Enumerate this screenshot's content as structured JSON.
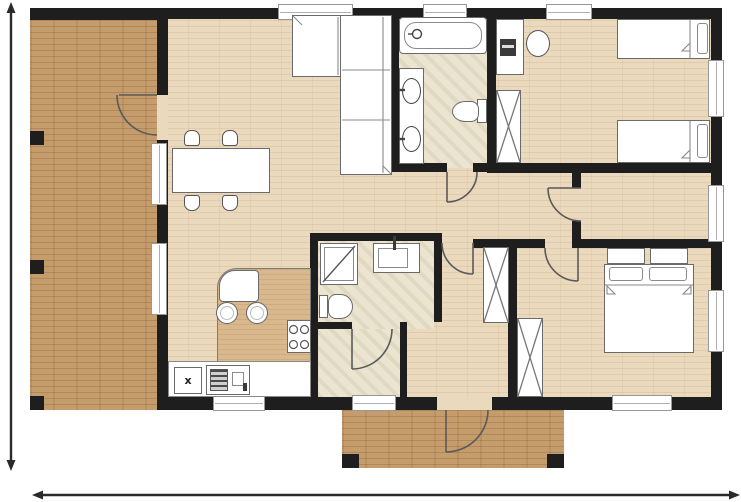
{
  "document": {
    "kind": "residential floor plan drawing",
    "style": "top-down architectural plan, unlabeled (no text on drawing)"
  },
  "palette": {
    "background": "#ffffff",
    "walls": "#1e1e1e",
    "deck_wood": "#c59c6c",
    "interior_wood": "#ead9bd",
    "bathroom_tile": "#ebe4d0",
    "counter_wood": "#d9b88e",
    "fixture_fill": "#ffffff",
    "fixture_outline": "#6a6a6a",
    "dimension_line": "#2a2a2a"
  },
  "labels": {
    "appliance": "x"
  },
  "dimension_markers": {
    "left_vertical": "double-headed arrow along full house height, no value printed",
    "bottom_horizontal": "double-headed arrow along full plan width, no value printed"
  },
  "openings": {
    "windows": 11,
    "door_swings": 7
  },
  "areas": [
    {
      "name": "deck-terrace",
      "contents": [
        "dark wood decking",
        "support posts",
        "door to living room"
      ]
    },
    {
      "name": "living-dining",
      "contents": [
        "l-shaped sofa",
        "dining table",
        "4 dining chairs"
      ]
    },
    {
      "name": "kitchen",
      "contents": [
        "island with rounded breakfast bar",
        "2 bar stools",
        "4-burner cooktop",
        "base counter",
        "double sink",
        "appliance marked x"
      ]
    },
    {
      "name": "family-bathroom",
      "contents": [
        "bathtub",
        "vanity with 2 basins",
        "toilet"
      ]
    },
    {
      "name": "shower-room",
      "contents": [
        "shower cabin",
        "toilet",
        "washbasin"
      ]
    },
    {
      "name": "hallway",
      "contents": [
        "wardrobe",
        "door swings"
      ]
    },
    {
      "name": "bedroom-top-right",
      "contents": [
        "2 single beds",
        "desk",
        "desk chair",
        "wardrobe"
      ]
    },
    {
      "name": "small-room-middle-right",
      "contents": []
    },
    {
      "name": "master-bedroom",
      "contents": [
        "double bed",
        "2 nightstands",
        "wardrobe"
      ]
    },
    {
      "name": "entry-porch",
      "contents": [
        "wood decking",
        "entry door swing",
        "2 posts"
      ]
    }
  ]
}
